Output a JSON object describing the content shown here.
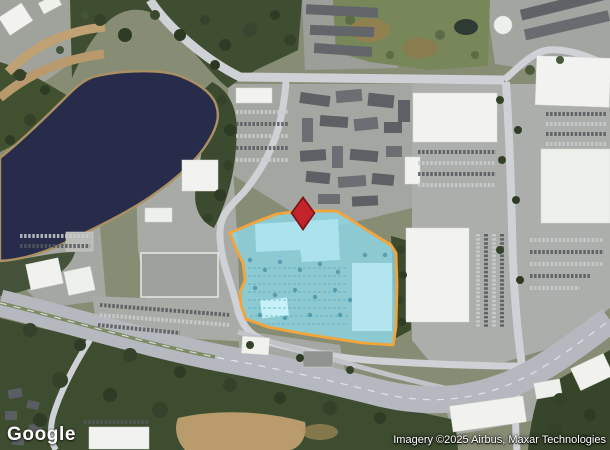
{
  "map": {
    "type": "satellite",
    "provider": {
      "logo_text": "Google"
    },
    "attribution": {
      "text": "Imagery ©2025 Airbus, Maxar Technologies"
    },
    "overlay": {
      "parcel": {
        "fill_color": "#8ed7e5",
        "border_color": "#f3a43a"
      },
      "marker": {
        "shape": "diamond-pin",
        "fill_color": "#c5232b",
        "border_color": "#7d1115"
      }
    }
  }
}
